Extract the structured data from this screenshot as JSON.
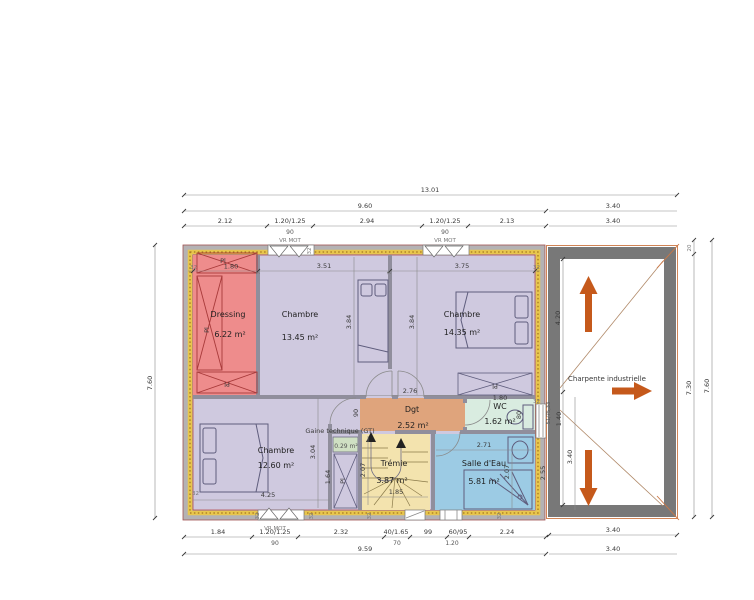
{
  "colors": {
    "bedroom_fill": "#cfc9df",
    "dressing_fill": "#ee8c8c",
    "dgt_fill": "#dfa47c",
    "wc_fill": "#d9ece0",
    "bath_fill": "#9ccbe4",
    "stair_fill": "#f3e3ae",
    "gt_fill": "#cfe0c3",
    "wall_gray": "#b4b2b4",
    "annex_wall": "#787878",
    "insulation": "#e8c64e",
    "arrow_orange": "#c5591b"
  },
  "rooms": {
    "dressing": {
      "name": "Dressing",
      "area": "6.22 m²"
    },
    "chambre1": {
      "name": "Chambre",
      "area": "13.45 m²"
    },
    "chambre2": {
      "name": "Chambre",
      "area": "14.35 m²"
    },
    "chambre3": {
      "name": "Chambre",
      "area": "12.60 m²"
    },
    "dgt": {
      "name": "Dgt",
      "area": "2.52 m²"
    },
    "wc": {
      "name": "WC",
      "area": "1.62 m²"
    },
    "bath": {
      "name": "Salle d'Eau",
      "area": "5.81 m²"
    },
    "stair": {
      "name": "Trémie",
      "area": "3.87 m²"
    },
    "gt": {
      "name": "Gaine technique (GT)",
      "area": "0.29 m²"
    },
    "annex": {
      "name": "Charpente industrielle"
    },
    "closet_label": "Pl"
  },
  "dims": {
    "top": {
      "total": "13.01",
      "main": "9.60",
      "annex_a": "3.40",
      "annex_b": "3.40",
      "seg1": "2.12",
      "seg2": "1.20/1.25",
      "seg3": "2.94",
      "seg4": "1.20/1.25",
      "seg5": "2.13",
      "w90a": "90",
      "w90b": "90",
      "vr_a": "VR MOT",
      "vr_b": "VR MOT"
    },
    "bottom": {
      "seg1": "1.84",
      "seg2": "1.20/1.25",
      "seg3": "2.32",
      "seg4": "40/1.65",
      "seg5": "99",
      "seg6": "60/95",
      "seg7": "2.24",
      "w90": "90",
      "d70": "70",
      "w120": "1.20",
      "total": "9.59",
      "annex_a": "3.40",
      "annex_b": "3.40",
      "vr": "VR MOT"
    },
    "left": {
      "total": "7.60"
    },
    "right": {
      "wall20": "20",
      "inner": "7.30",
      "outer": "7.60"
    },
    "interior": {
      "dressing_w": "1.80",
      "ch1_w": "3.51",
      "ch2_w": "3.75",
      "ch1_h": "3.84",
      "ch2_h": "3.84",
      "ch3_w": "4.25",
      "ch3_h": "3.04",
      "gt_h": "1.64",
      "dgt_w": "2.76",
      "dgt_h": "90",
      "wc_w": "1.80",
      "wc_h": "80",
      "bath_w": "2.71",
      "bath_h": "2.07",
      "stair_w": "1.85",
      "stair_h": "2.07",
      "annex_a": "4.20",
      "annex_b": "1.40",
      "annex_c": "3.40",
      "annex_d": "2.55",
      "annex_sill": "51/75,33",
      "wall32": "32",
      "wall7": "7"
    }
  }
}
